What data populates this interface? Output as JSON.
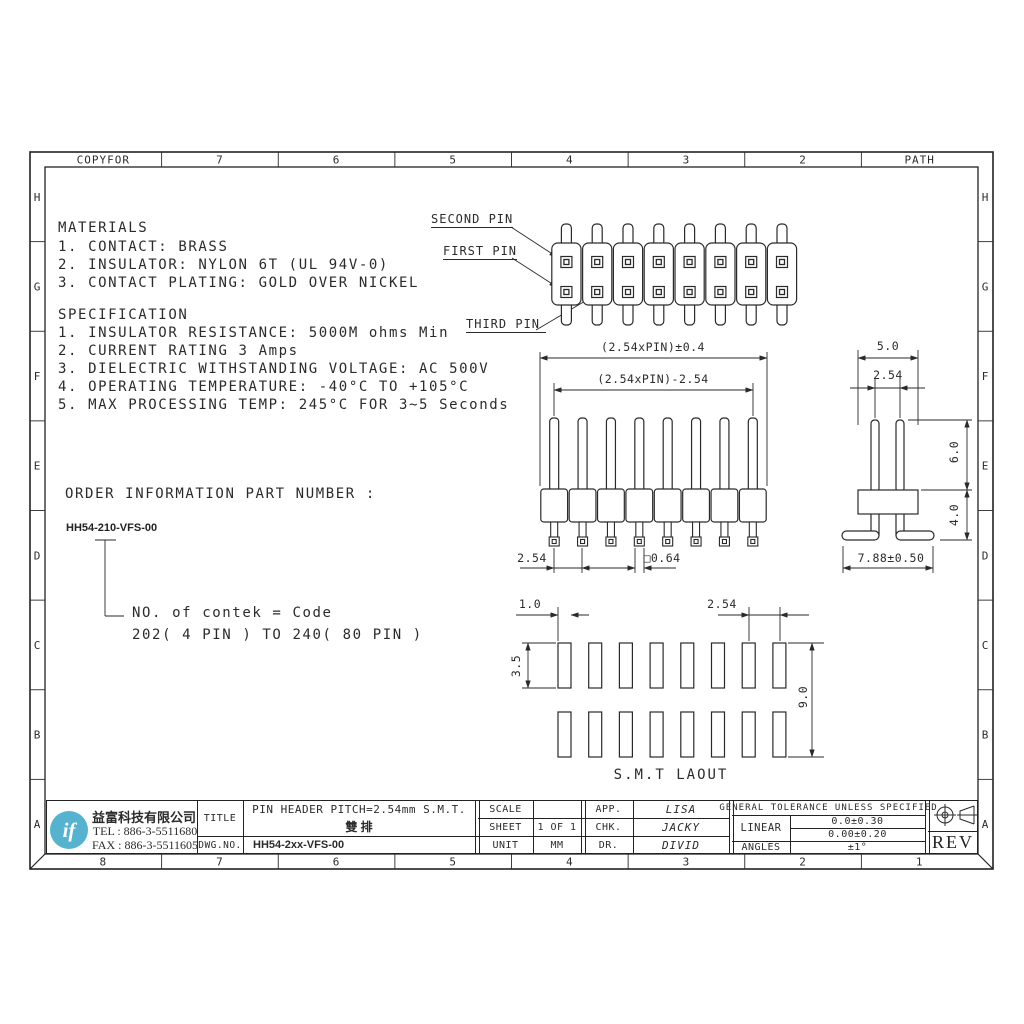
{
  "sheet": {
    "top_ruler": [
      "COPYFOR",
      "7",
      "6",
      "5",
      "4",
      "3",
      "2",
      "PATH"
    ],
    "bottom_ruler": [
      "8",
      "7",
      "6",
      "5",
      "4",
      "3",
      "2",
      "1"
    ],
    "side_ruler": [
      "H",
      "G",
      "F",
      "E",
      "D",
      "C",
      "B",
      "A"
    ]
  },
  "materials": {
    "heading": "MATERIALS",
    "items": [
      "1. CONTACT: BRASS",
      "2. INSULATOR: NYLON 6T (UL 94V-0)",
      "3. CONTACT PLATING: GOLD OVER NICKEL"
    ]
  },
  "specification": {
    "heading": "SPECIFICATION",
    "items": [
      "1. INSULATOR RESISTANCE: 5000M ohms Min",
      "2. CURRENT RATING 3 Amps",
      "3. DIELECTRIC WITHSTANDING VOLTAGE: AC 500V",
      "4. OPERATING TEMPERATURE: -40°C TO +105°C",
      "5. MAX PROCESSING TEMP: 245°C FOR 3~5 Seconds"
    ]
  },
  "order_info": {
    "heading": "ORDER INFORMATION PART NUMBER :",
    "part_number": "HH54-210-VFS-00",
    "note_line1": "NO. of contek = Code",
    "note_line2": "202( 4 PIN ) TO 240( 80 PIN )"
  },
  "pin_labels": {
    "second": "SECOND PIN",
    "first": "FIRST PIN",
    "third": "THIRD PIN"
  },
  "dimensions": {
    "front_overall": "(2.54xPIN)±0.4",
    "front_span": "(2.54xPIN)-2.54",
    "front_pitch": "2.54",
    "front_pin_sq": "□0.64",
    "side_width": "5.0",
    "side_pitch": "2.54",
    "side_pin_h": "6.0",
    "side_body_h": "4.0",
    "side_foot_span": "7.88±0.50",
    "smt_pad_w": "1.0",
    "smt_pitch": "2.54",
    "smt_pad_h": "3.5",
    "smt_row_span": "9.0",
    "smt_label": "S.M.T LAOUT"
  },
  "drawing": {
    "pins_per_row": 8,
    "rows": 2
  },
  "title_block": {
    "logo_text": "if",
    "company": "益富科技有限公司",
    "tel": "TEL : 886-3-5511680",
    "fax": "FAX : 886-3-5511605",
    "title_label": "TITLE",
    "title_line1": "PIN HEADER PITCH=2.54mm S.M.T.",
    "title_line2": "雙 排",
    "dwg_label": "DWG.NO.",
    "dwg_no": "HH54-2xx-VFS-00",
    "scale_label": "SCALE",
    "scale_value": "",
    "sheet_label": "SHEET",
    "sheet_value": "1 OF 1",
    "unit_label": "UNIT",
    "unit_value": "MM",
    "app_label": "APP.",
    "app_value": "LISA",
    "chk_label": "CHK.",
    "chk_value": "JACKY",
    "dr_label": "DR.",
    "dr_value": "DIVID",
    "tolerance_header": "GENERAL TOLERANCE UNLESS SPECIFIED",
    "linear_label": "LINEAR",
    "linear_tol1": "0.0±0.30",
    "linear_tol2": "0.00±0.20",
    "angles_label": "ANGLES",
    "angles_value": "±1°",
    "rev": "REV"
  },
  "colors": {
    "line": "#2a2a2a",
    "logo_blue": "#56b3cf",
    "paper": "#ffffff"
  }
}
